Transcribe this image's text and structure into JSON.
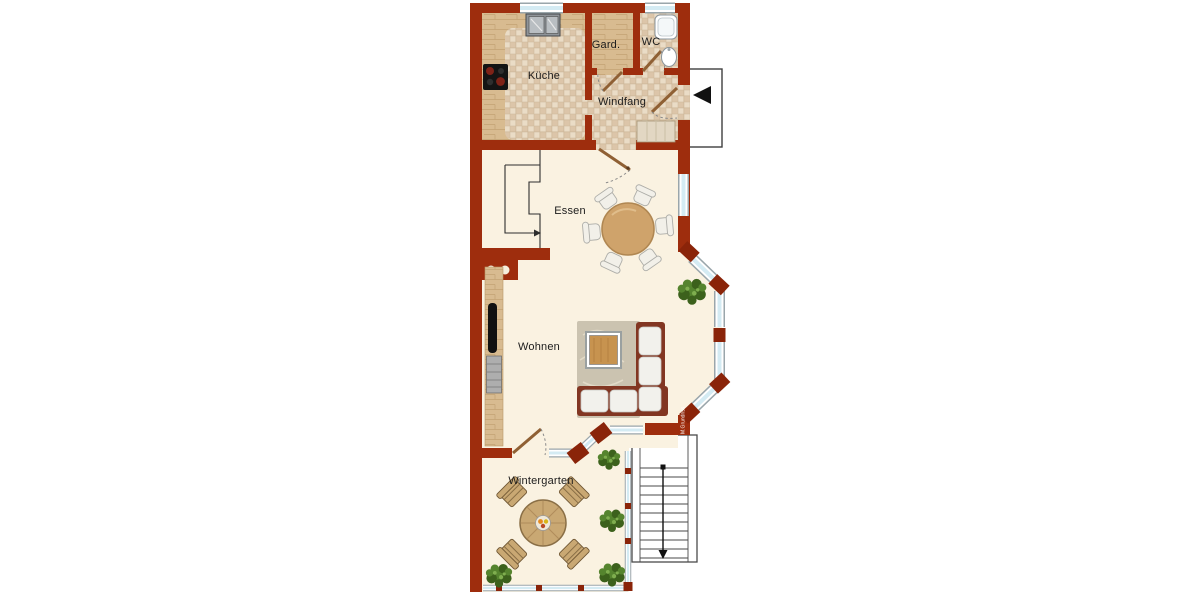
{
  "plan": {
    "type": "apartment floor plan",
    "rooms": [
      {
        "id": "kueche",
        "label": "Küche",
        "fixtures": [
          "double sink",
          "cooktop",
          "tiled floor",
          "wood counter"
        ]
      },
      {
        "id": "gard",
        "label": "Gard.",
        "fixtures": [
          "wood floor"
        ]
      },
      {
        "id": "wc",
        "label": "WC",
        "fixtures": [
          "shower tray",
          "washbasin",
          "tiled floor"
        ]
      },
      {
        "id": "windfang",
        "label": "Windfang",
        "fixtures": [
          "doormat",
          "tiled floor",
          "entrance door"
        ]
      },
      {
        "id": "essen",
        "label": "Essen",
        "fixtures": [
          "round dining table",
          "six chairs",
          "upper-stair outline",
          "chimney with two flues"
        ]
      },
      {
        "id": "wohnen",
        "label": "Wohnen",
        "fixtures": [
          "corner sofa",
          "coffee table",
          "rug",
          "tv sideboard",
          "plant",
          "bay window"
        ]
      },
      {
        "id": "wintergarten",
        "label": "Wintergarten",
        "fixtures": [
          "round table",
          "four diagonal chairs",
          "fruit bowl",
          "four plants",
          "glazed walls"
        ]
      }
    ],
    "exterior": {
      "entrance_porch": "entrance landing with left-pointing arrow",
      "stairs": "exterior staircase with 11 treads and downward arrow"
    },
    "watermark": "M.Grundriss"
  },
  "icons": {
    "entrance_arrow": "◀",
    "stairs_direction_arrow": "▼"
  },
  "colors": {
    "wall": "#9E2D0D",
    "wall_dark": "#8A2409",
    "floor": "#FAF2E1",
    "tile_a": "#EADCC6",
    "tile_b": "#DCC5A9",
    "tile_line": "#CDB79A",
    "wood": "#D8BB90",
    "wood_line": "#C3A273",
    "glass": "#D4EBF3",
    "window_frame": "#FFFFFF",
    "window_outline": "#9AA6AB",
    "door": "#8F6034",
    "sofa": "#823622",
    "cushion": "#F2F1EC",
    "rug": "#CBC3B0",
    "table_wood": "#CFA36B",
    "plant": "#55842E",
    "plant_dark": "#3C611C",
    "stair_line": "#4A4A4A",
    "ink": "#1C1C1C"
  }
}
